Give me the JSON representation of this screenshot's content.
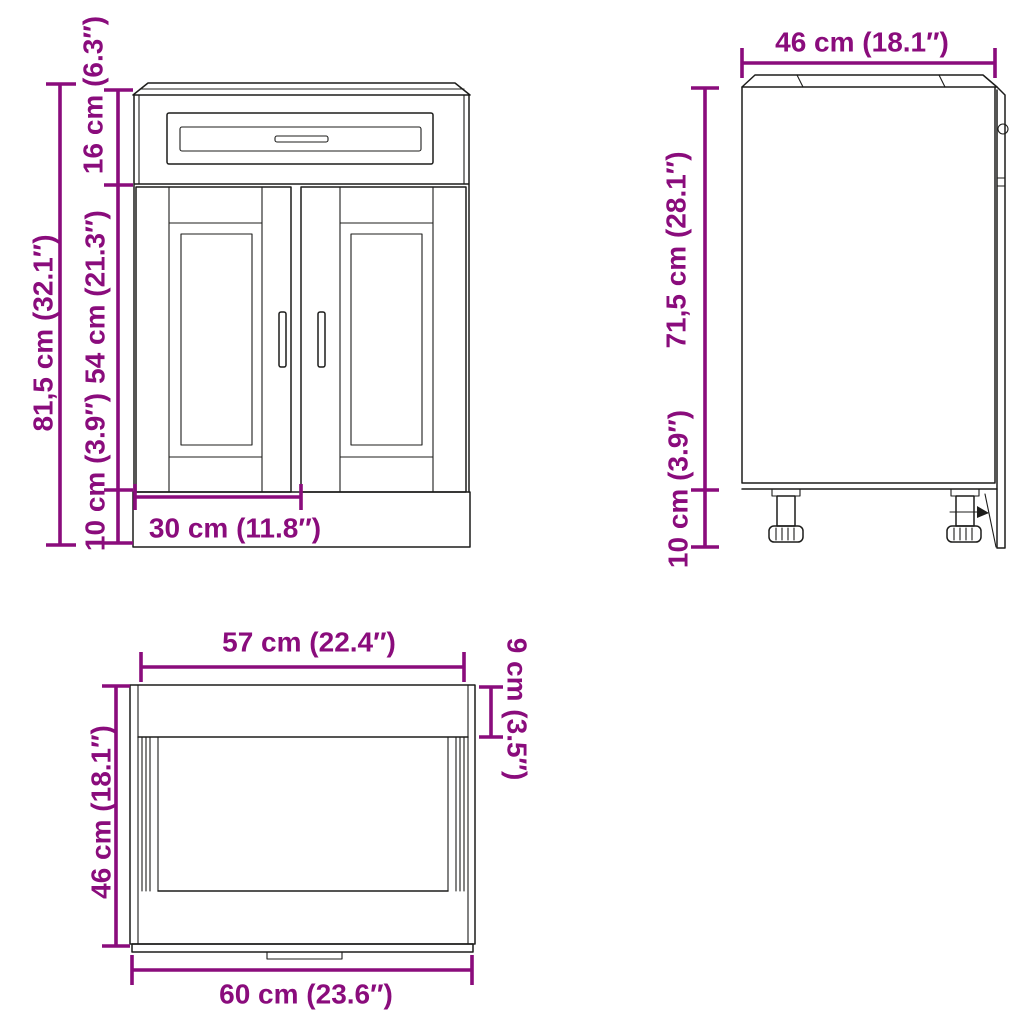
{
  "colors": {
    "dimension": "#8a0c7c",
    "line": "#1d1d1b",
    "background": "#ffffff"
  },
  "front": {
    "dims": {
      "total_height": "81,5 cm (32.1″)",
      "drawer_height": "16 cm (6.3″)",
      "door_height": "54 cm (21.3″)",
      "plinth_height": "10 cm (3.9″)",
      "door_width": "30 cm (11.8″)"
    }
  },
  "side": {
    "dims": {
      "depth": "46 cm (18.1″)",
      "body_height": "71,5 cm (28.1″)",
      "leg_height": "10 cm (3.9″)"
    }
  },
  "top": {
    "dims": {
      "front_width": "57 cm (22.4″)",
      "back_band_depth": "9 cm (3.5″)",
      "depth": "46 cm (18.1″)",
      "total_width": "60 cm (23.6″)"
    }
  }
}
